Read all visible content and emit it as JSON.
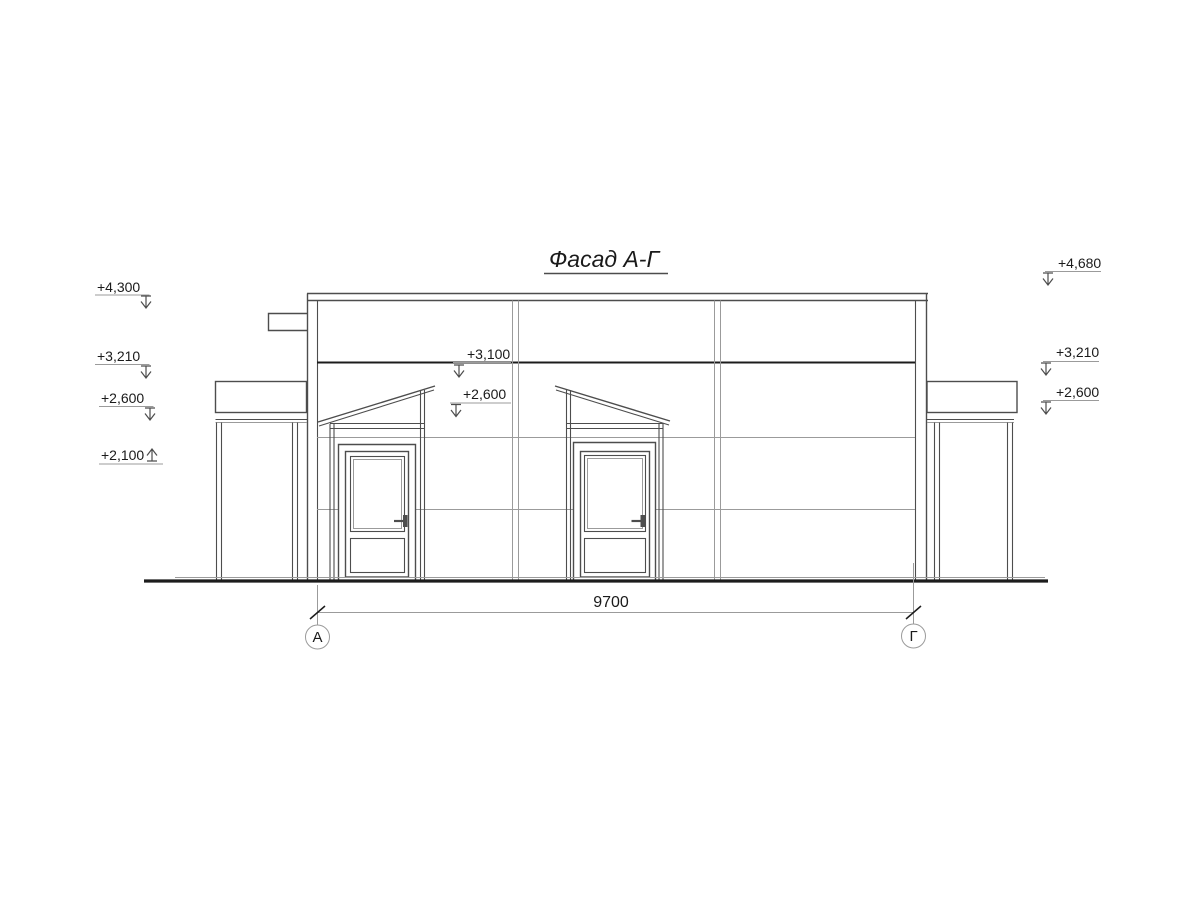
{
  "drawing": {
    "title": "Фасад А-Г",
    "elevations": {
      "left": [
        {
          "label": "+4,300"
        },
        {
          "label": "+3,210"
        },
        {
          "label": "+2,600"
        },
        {
          "label": "+2,100"
        }
      ],
      "middle": [
        {
          "label": "+3,100"
        },
        {
          "label": "+2,600"
        }
      ],
      "right": [
        {
          "label": "+4,680"
        },
        {
          "label": "+3,210"
        },
        {
          "label": "+2,600"
        }
      ]
    },
    "dimension": {
      "value": "9700"
    },
    "axes": [
      {
        "label": "А"
      },
      {
        "label": "Г"
      }
    ],
    "colors": {
      "line_dark": "#1c1c1c",
      "line_medium": "#4d4d4d",
      "line_light": "#9b9b9b",
      "background": "#ffffff"
    }
  }
}
